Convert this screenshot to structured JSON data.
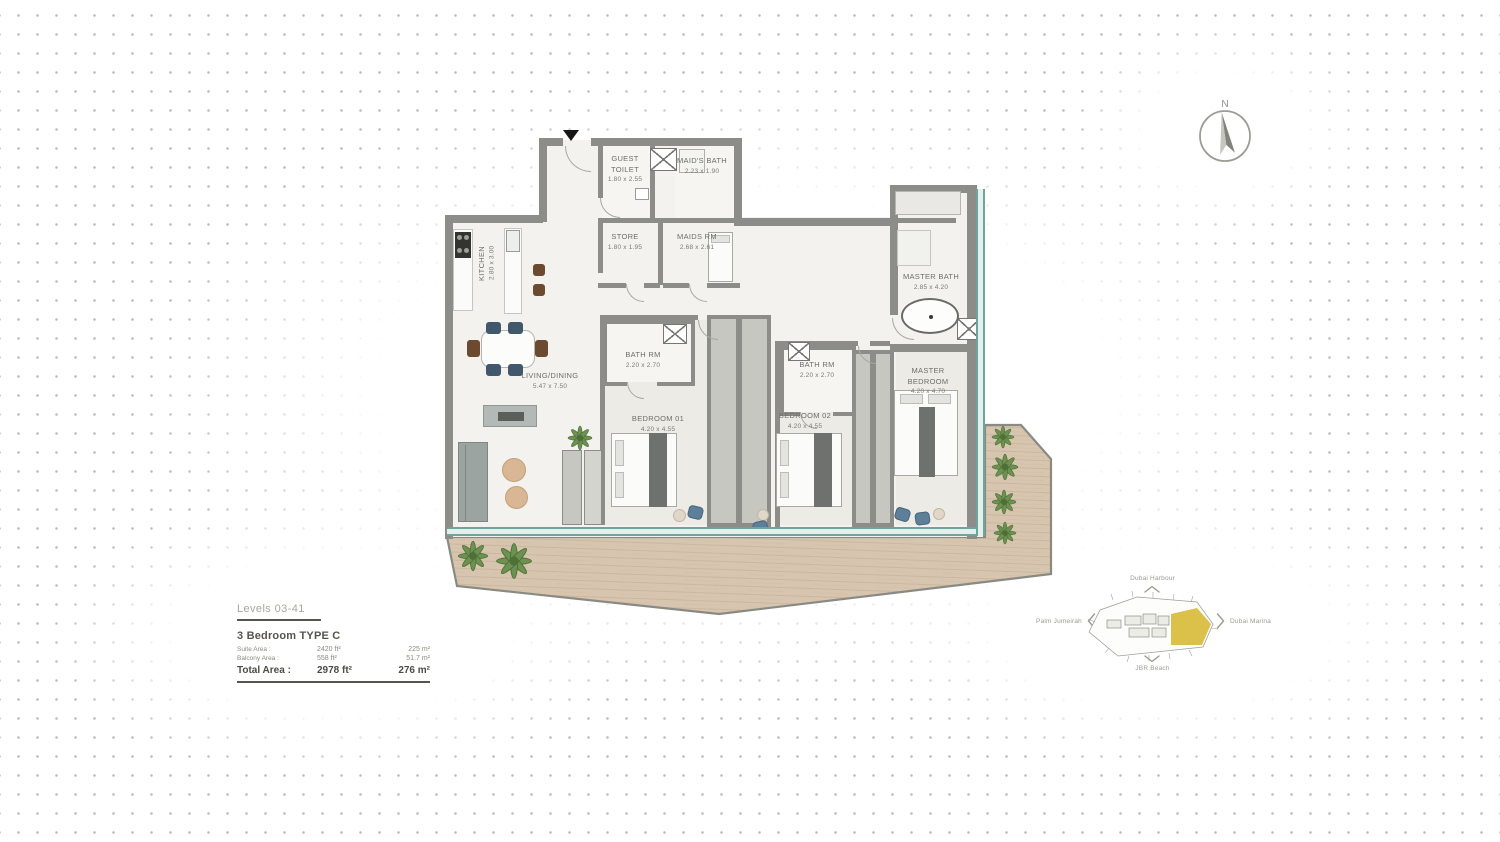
{
  "compass": {
    "north_label": "N"
  },
  "floorplan": {
    "rooms": [
      {
        "id": "kitchen",
        "name": "KITCHEN",
        "dim": "2.80 x 3.00"
      },
      {
        "id": "guest-toilet",
        "name": "GUEST TOILET",
        "dim": "1.80 x 2.55"
      },
      {
        "id": "maids-bath",
        "name": "MAID'S BATH",
        "dim": "2.23 x 1.90"
      },
      {
        "id": "store",
        "name": "STORE",
        "dim": "1.80 x 1.95"
      },
      {
        "id": "maids-rm",
        "name": "MAIDS RM",
        "dim": "2.68 x 2.61"
      },
      {
        "id": "living-dining",
        "name": "LIVING/DINING",
        "dim": "5.47 x 7.50"
      },
      {
        "id": "bath-rm-1",
        "name": "BATH RM",
        "dim": "2.20 x 2.70"
      },
      {
        "id": "bedroom-01",
        "name": "BEDROOM 01",
        "dim": "4.20 x 4.55"
      },
      {
        "id": "bath-rm-2",
        "name": "BATH RM",
        "dim": "2.20 x 2.70"
      },
      {
        "id": "bedroom-02",
        "name": "BEDROOM 02",
        "dim": "4.20 x 4.55"
      },
      {
        "id": "master-bath",
        "name": "MASTER BATH",
        "dim": "2.85 x 4.20"
      },
      {
        "id": "master-bedroom",
        "name": "MASTER BEDROOM",
        "dim": "4.20 x 4.70"
      }
    ]
  },
  "legend": {
    "levels": "Levels 03-41",
    "unit_type": "3 Bedroom  TYPE C",
    "areas": [
      {
        "label": "Suite Area :",
        "ft": "2420 ft²",
        "m": "225 m²"
      },
      {
        "label": "Balcony Area :",
        "ft": "558 ft²",
        "m": "51.7 m²"
      },
      {
        "label": "Total Area :",
        "ft": "2978 ft²",
        "m": "276 m²"
      }
    ]
  },
  "keyplan": {
    "labels": {
      "top": "Dubai Harbour",
      "left": "Palm Jumeirah",
      "right": "Dubai Marina",
      "bottom": "JBR Beach"
    },
    "highlight_color": "#d9bd3f"
  },
  "colors": {
    "wall": "#8c8c88",
    "glass": "#6fa49c",
    "balcony_wood": "#d7c5af",
    "accent_yellow": "#d9bd3f"
  }
}
